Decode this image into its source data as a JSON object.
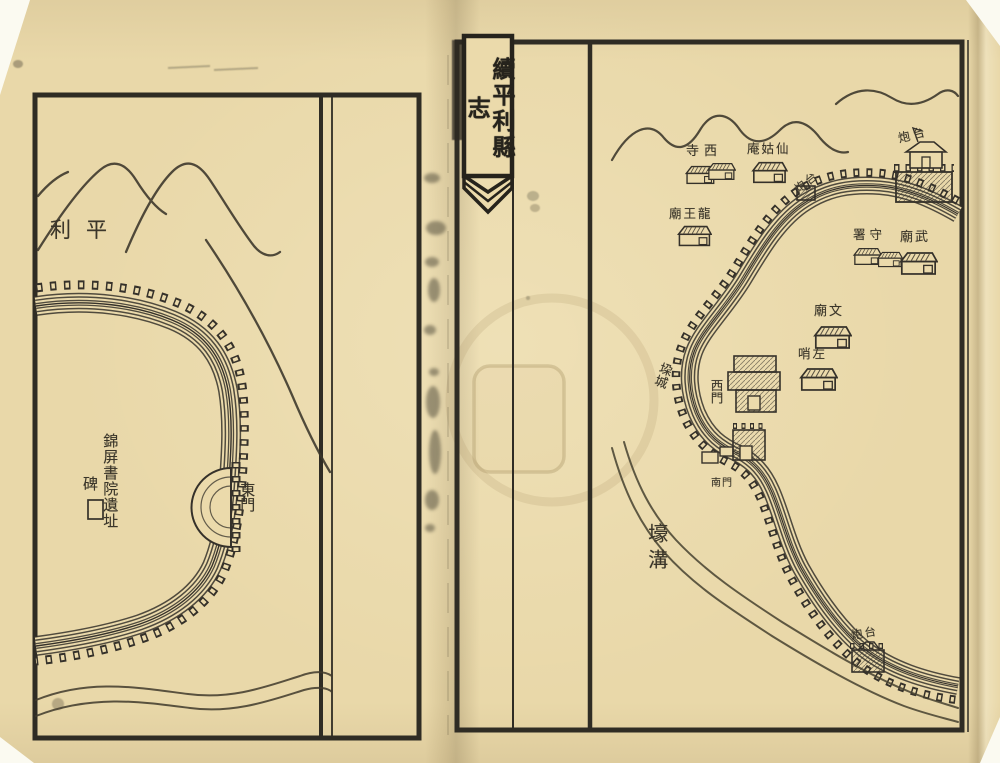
{
  "banner": {
    "title": "續平利縣志"
  },
  "left_map": {
    "region_label": "利平",
    "east_gate": "東門",
    "academy_site": "錦屏書院遺址",
    "stele": "碑"
  },
  "right_map": {
    "west_temple": "寺西",
    "xiangu_nunnery": "庵姑仙",
    "dragon_king_temple": "廟王龍",
    "battery_northeast": "炮台",
    "battery_corner": "炮台",
    "garrison_office": "署守",
    "martial_temple": "廟武",
    "civil_temple": "廟文",
    "left_picket": "哨左",
    "battlements": "垜城",
    "west_gate": "西門",
    "south_gate": "南門",
    "moat": "壕溝",
    "battery_southeast": "炮台"
  },
  "colors": {
    "paper": "#ebdaab",
    "ink": "#35312a"
  }
}
